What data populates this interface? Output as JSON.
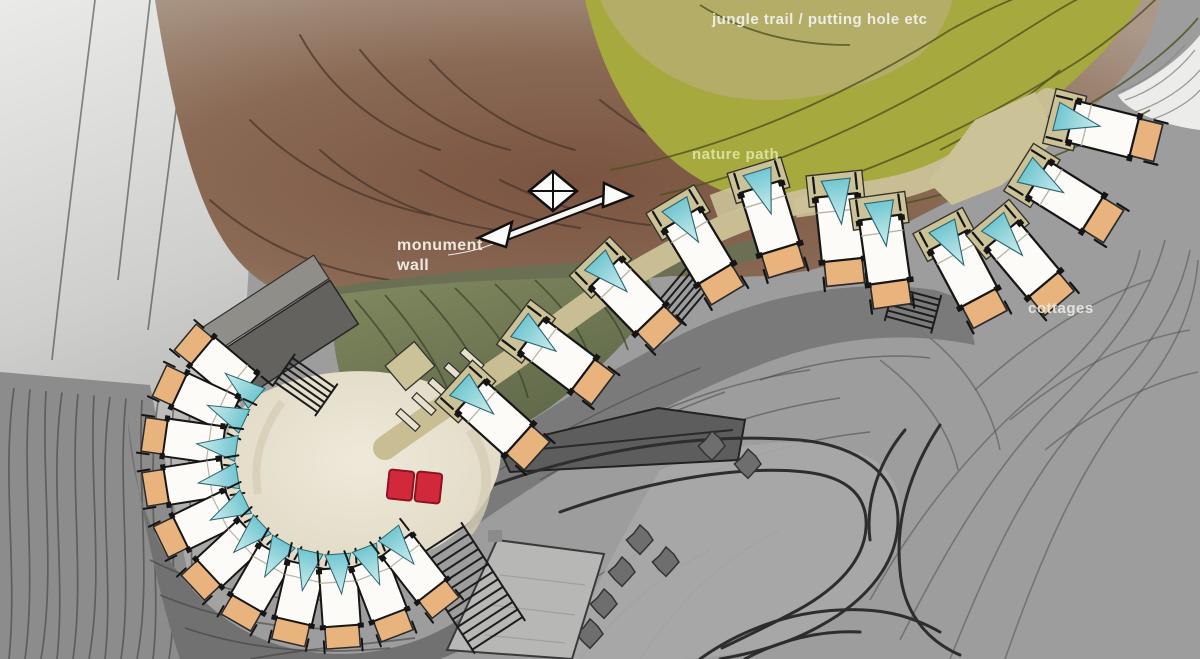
{
  "title": "resort hillside masterplan sketch",
  "labels": {
    "jungle_trail": {
      "text": "jungle trail / putting hole etc",
      "x": 712,
      "y": 11,
      "color": "#f0f0ea",
      "size": 15
    },
    "nature_path": {
      "text": "nature path",
      "x": 692,
      "y": 146,
      "color": "#dce3a2",
      "size": 15
    },
    "monument_wall": {
      "text": "monument wall",
      "x": 397,
      "y": 236,
      "color": "#f2efe8",
      "size": 16,
      "width": 118
    },
    "cottages": {
      "text": "cottages",
      "x": 1028,
      "y": 300,
      "color": "#e6e6e2",
      "size": 15
    }
  },
  "colors": {
    "base_gray": "#9d9d9d",
    "left_light": "#e7e7e5",
    "left_mid": "#a6a6a4",
    "lowleft_gray": "#8c8c8c",
    "dark_surround": "#717171",
    "brown_core": "#7a5440",
    "brown_mid": "#8a6a55",
    "brown_edge": "#ab9888",
    "brown_line": "#46332a",
    "olive": "#a6a93e",
    "olive_light": "#b3ad68",
    "olive_line": "#4e511f",
    "slope_hi": "#828a60",
    "slope_lo": "#5c6547",
    "slope_line": "#3e452e",
    "band_green": "#6b7054",
    "court_hi": "#ece7d8",
    "court_lo": "#ded6c0",
    "court_shade": "#d6cdb5",
    "walk_khaki": "#c8bd93",
    "khaki": "#cbc298",
    "roof_white": "#fcfbf7",
    "ink": "#161616",
    "orange": "#e9b37e",
    "cyan_hi": "#cfeeee",
    "cyan_lo": "#72c6d1",
    "red": "#d2293a",
    "red_dark": "#8e1322",
    "deck_dark": "#63625e",
    "deck_mid": "#8f8e89",
    "road_line": "#2d2d2d",
    "road_dark": "#5d5d5d",
    "blob": "#6e6e6e",
    "shadow_band": "#777777",
    "bldg": "#b7b7b5",
    "contour": "#4b4b4b",
    "white_corner": "#ececea",
    "hatch": "#8a8a8a"
  },
  "plan": {
    "cluster_units": [
      [
        222,
        368,
        310
      ],
      [
        203,
        401,
        295
      ],
      [
        191,
        441,
        278
      ],
      [
        192,
        482,
        261
      ],
      [
        204,
        521,
        244
      ],
      [
        228,
        555,
        227
      ],
      [
        260,
        581,
        210
      ],
      [
        299,
        596,
        193
      ],
      [
        340,
        600,
        176
      ],
      [
        380,
        591,
        159
      ],
      [
        416,
        570,
        142
      ]
    ],
    "chain_units": [
      [
        497,
        420,
        132
      ],
      [
        560,
        357,
        127
      ],
      [
        630,
        298,
        136
      ],
      [
        700,
        249,
        149
      ],
      [
        771,
        221,
        163
      ],
      [
        840,
        231,
        174
      ],
      [
        885,
        253,
        172
      ],
      [
        965,
        272,
        152
      ],
      [
        1025,
        262,
        140
      ],
      [
        1068,
        198,
        122
      ],
      [
        1106,
        130,
        104
      ]
    ],
    "red_unit": [
      414,
      486,
      96
    ],
    "steps": [
      [
        686,
        292,
        -50,
        26,
        6
      ],
      [
        913,
        308,
        15,
        24,
        6
      ],
      [
        305,
        385,
        35,
        26,
        6
      ],
      [
        468,
        588,
        -33,
        30,
        13
      ]
    ],
    "pergola_bars": [
      [
        408,
        420
      ],
      [
        424,
        404
      ],
      [
        440,
        389
      ],
      [
        456,
        374
      ],
      [
        472,
        359
      ]
    ],
    "rock_blobs": [
      [
        712,
        446
      ],
      [
        748,
        464
      ],
      [
        640,
        540
      ],
      [
        622,
        572
      ],
      [
        604,
        604
      ],
      [
        590,
        634
      ],
      [
        666,
        562
      ]
    ]
  }
}
